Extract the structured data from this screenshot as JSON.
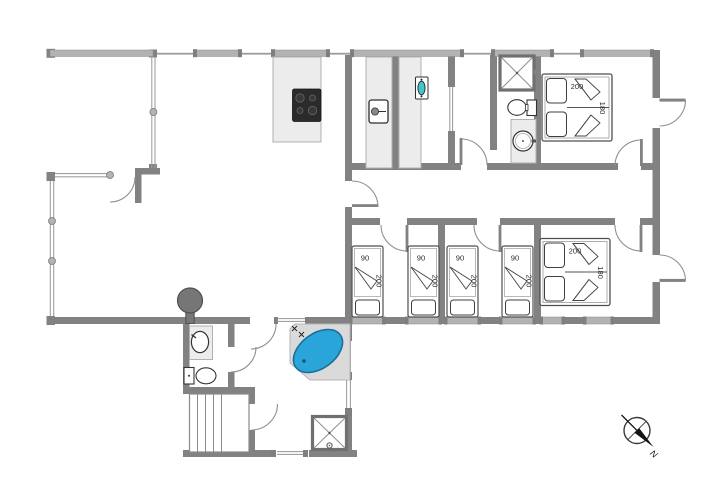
{
  "plan": {
    "type": "holiday-house-floor-plan",
    "colors": {
      "wall": "#828282",
      "window_bar": "#b3b3b3",
      "fixture_fill": "#ececec",
      "spa_blue": "#29a5d9",
      "utility_sink_teal": "#3fc6cf",
      "cooktop_black": "#2b2b2b",
      "stove_gray": "#767676"
    },
    "fixtures": [
      "cooktop-4-burners",
      "washing-machine",
      "utility-sink",
      "shower-cabin-top",
      "toilet-top",
      "washbasin-top",
      "shower-cabin-bottom",
      "toilet-bottom",
      "washbasin-bottom",
      "corner-spa-bath",
      "wood-burning-stove",
      "stairs",
      "compass-rose"
    ]
  },
  "beds": {
    "single": {
      "count": 4,
      "width_label": "90",
      "length_label": "200"
    },
    "double_top": {
      "width_label": "200",
      "depth_label": "180"
    },
    "double_bottom": {
      "width_label": "200",
      "depth_label": "180"
    }
  },
  "compass": {
    "north_label": "N"
  }
}
